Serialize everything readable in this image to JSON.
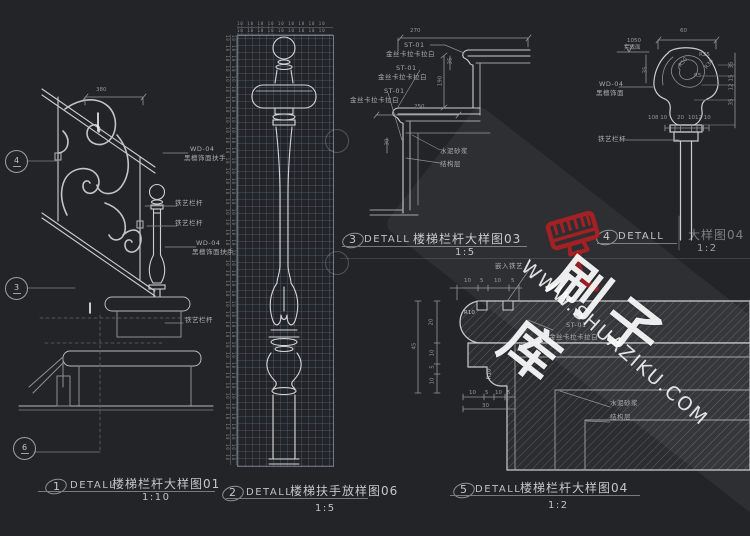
{
  "watermark": {
    "brand": "刷子库",
    "url": "WWW.SHUAZIKU.COM"
  },
  "details": {
    "d1": {
      "num": "1",
      "kind": "DETALL",
      "title": "楼梯栏杆大样图01",
      "scale": "1:10",
      "dim_width": "380",
      "ref_top": "4",
      "ref_mid": "3",
      "ref_bot": "6",
      "wd_code": "WD-04",
      "wd_name": "黑檀饰面扶手",
      "iron": "铁艺栏杆"
    },
    "d2": {
      "num": "2",
      "kind": "DETALL",
      "title": "楼梯扶手放样图06",
      "scale": "1:5",
      "ruler_unit": "10"
    },
    "d3": {
      "num": "3",
      "kind": "DETALL",
      "title": "楼梯栏杆大样图03",
      "scale": "1:5",
      "stone_code": "ST-01",
      "stone_name": "金丝卡拉卡拉白",
      "mortar": "水泥砂浆",
      "structure": "结构层",
      "dim_270": "270",
      "dim_250": "250",
      "dim_190": "190",
      "dim_35": "35",
      "dim_30": "30"
    },
    "d4": {
      "num": "4",
      "kind": "DETALL",
      "title": "大样图04",
      "scale": "1:2",
      "level_value": "1050",
      "level_name": "完成面",
      "wd_code": "WD-04",
      "wd_name": "黑檀饰面",
      "iron": "铁艺栏杆",
      "dim_60": "60",
      "r50": "R50",
      "r25": "R25",
      "r30": "R30",
      "r5": "R5",
      "right_dims": [
        "35",
        "15",
        "12",
        "35"
      ],
      "left_dim": "35",
      "bot_left": "108 10",
      "bot_mid": "20",
      "bot_right": "1012 10"
    },
    "d5": {
      "num": "5",
      "kind": "DETALL",
      "title": "楼梯栏杆大样图04",
      "scale": "1:2",
      "embed": "嵌入铁艺",
      "stone_code": "ST-01",
      "stone_name": "金丝卡拉卡拉白",
      "mortar": "水泥砂浆",
      "structure": "结构层",
      "top_dims": [
        "10",
        "5",
        "10",
        "5"
      ],
      "left_dims": [
        "20",
        "10",
        "5",
        "10"
      ],
      "left_total": "45",
      "bot_dims": [
        "10",
        "5",
        "10",
        "5"
      ],
      "bot_total": "30",
      "r10": "R10"
    }
  }
}
